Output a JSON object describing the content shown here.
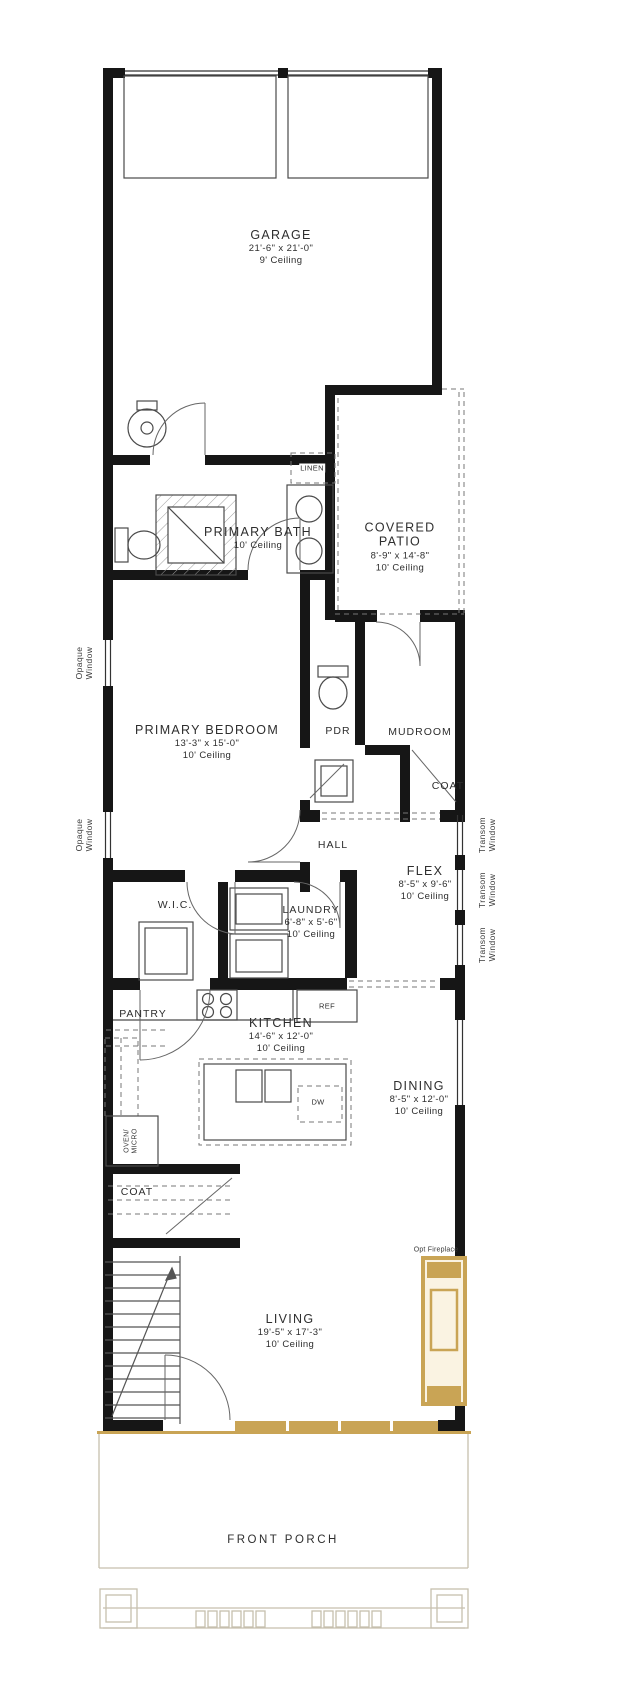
{
  "colors": {
    "wall": "#161616",
    "accent_tan": "#C9A455",
    "porch_line": "#c6bfae",
    "fixture_line": "#4a4a4a",
    "text": "#2e2e2e"
  },
  "rooms": {
    "garage": {
      "name": "GARAGE",
      "dims": "21'-6\" x 21'-0\"",
      "ceiling": "9' Ceiling"
    },
    "primary_bath": {
      "name": "PRIMARY BATH",
      "ceiling": "10' Ceiling"
    },
    "covered_patio": {
      "name": "COVERED PATIO",
      "dims": "8'-9\" x 14'-8\"",
      "ceiling": "10' Ceiling"
    },
    "primary_bedroom": {
      "name": "PRIMARY BEDROOM",
      "dims": "13'-3\" x 15'-0\"",
      "ceiling": "10' Ceiling"
    },
    "pdr": {
      "name": "PDR"
    },
    "mudroom": {
      "name": "MUDROOM"
    },
    "coat_upper": {
      "name": "COAT"
    },
    "hall": {
      "name": "HALL"
    },
    "flex": {
      "name": "FLEX",
      "dims": "8'-5\" x 9'-6\"",
      "ceiling": "10' Ceiling"
    },
    "wic": {
      "name": "W.I.C."
    },
    "laundry": {
      "name": "LAUNDRY",
      "dims": "6'-8\" x 5'-6\"",
      "ceiling": "10' Ceiling"
    },
    "pantry": {
      "name": "PANTRY"
    },
    "kitchen": {
      "name": "KITCHEN",
      "dims": "14'-6\" x 12'-0\"",
      "ceiling": "10' Ceiling"
    },
    "dining": {
      "name": "DINING",
      "dims": "8'-5\" x 12'-0\"",
      "ceiling": "10' Ceiling"
    },
    "coat_lower": {
      "name": "COAT"
    },
    "living": {
      "name": "LIVING",
      "dims": "19'-5\" x 17'-3\"",
      "ceiling": "10' Ceiling"
    },
    "front_porch": {
      "name": "FRONT PORCH"
    }
  },
  "labels": {
    "linen": "LINEN",
    "ref": "REF",
    "dw": "DW",
    "oven_micro": "OVEN/\nMICRO",
    "opt_fireplace": "Opt Fireplace",
    "opaque_window": "Opaque\nWindow",
    "transom_window": "Transom\nWindow"
  }
}
